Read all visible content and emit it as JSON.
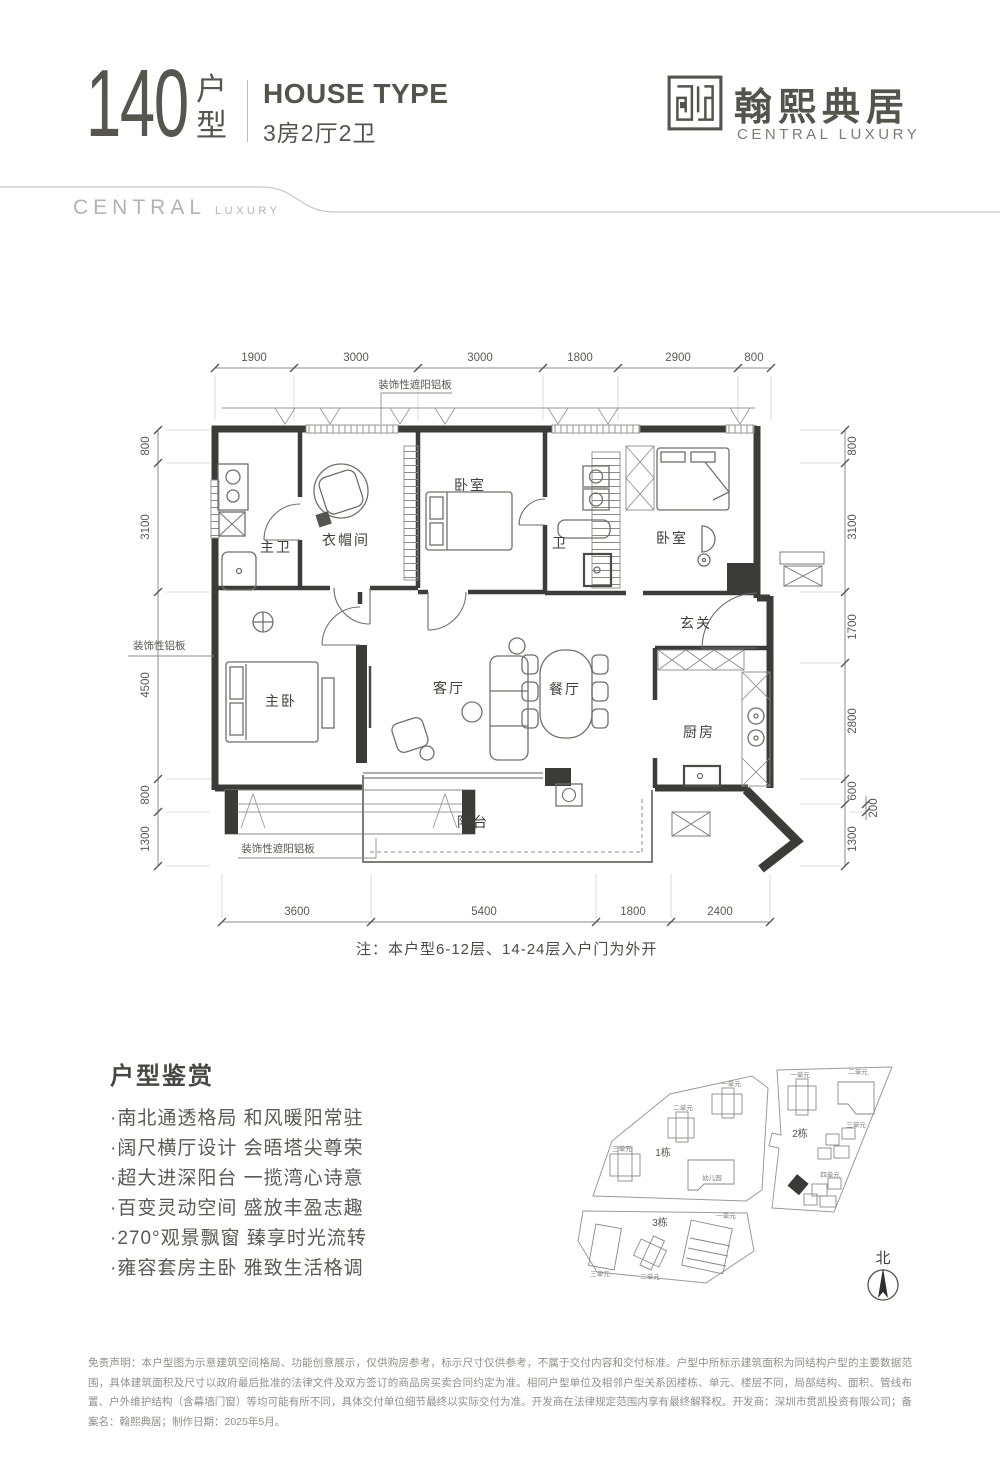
{
  "header": {
    "type_number": "140",
    "type_unit_top": "户",
    "type_unit_bottom": "型",
    "house_type_en": "HOUSE TYPE",
    "house_type_cn": "3房2厅2卫"
  },
  "brand": {
    "logo_cn": "翰熙典居",
    "logo_en": "CENTRAL LUXURY",
    "watermark_main": "CENTRAL",
    "watermark_sub": "LUXURY"
  },
  "floor_plan": {
    "dims_top": [
      "1900",
      "3000",
      "3000",
      "1800",
      "2900",
      "800"
    ],
    "dims_bottom": [
      "3600",
      "5400",
      "1800",
      "2400"
    ],
    "dims_left": [
      "800",
      "3100",
      "4500",
      "800",
      "1300"
    ],
    "dims_right": [
      "800",
      "3100",
      "1700",
      "2800",
      "600",
      "200",
      "1300"
    ],
    "rooms": {
      "master_bath": "主卫",
      "cloak_room": "衣帽间",
      "bedroom1": "卧室",
      "bath": "卫",
      "bedroom2": "卧室",
      "foyer": "玄关",
      "master_bedroom": "主卧",
      "living_room": "客厅",
      "dining_room": "餐厅",
      "kitchen": "厨房",
      "balcony": "阳台"
    },
    "annotation_top": "装饰性遮阳铝板",
    "annotation_left": "装饰性铝板",
    "annotation_bottom": "装饰性遮阳铝板",
    "note": "注：本户型6-12层、14-24层入户门为外开"
  },
  "features": {
    "title": "户型鉴赏",
    "items": [
      "·南北通透格局 和风暖阳常驻",
      "·阔尺横厅设计 会晤塔尖尊荣",
      "·超大进深阳台 一揽湾心诗意",
      "·百变灵动空间 盛放丰盈志趣",
      "·270°观景飘窗 臻享时光流转",
      "·雍容套房主卧 雅致生活格调"
    ]
  },
  "site_plan": {
    "parcel1": {
      "building": "1栋",
      "unit1": "一单元",
      "unit2": "二单元",
      "unit3": "三单元",
      "kindergarten": "幼儿园"
    },
    "parcel2": {
      "building": "2栋",
      "unit1": "一单元",
      "unit2": "二单元",
      "unit3": "三单元",
      "unit4": "四单元"
    },
    "parcel3": {
      "building": "3栋",
      "unit1": "一单元",
      "unit2": "二单元",
      "unit3": "三单元"
    },
    "north": "北"
  },
  "disclaimer": "免责声明：本户型图为示意建筑空间格局、功能创意展示，仅供购房参考，标示尺寸仅供参考，不属于交付内容和交付标准。户型中所标示建筑面积为同结构户型的主要数据范围，具体建筑面积及尺寸以政府最后批准的法律文件及双方签订的商品房买卖合同约定为准。相同户型单位及相邻户型关系因楼栋、单元、楼层不同，局部结构、面积、管线布置、户外维护结构（含幕墙门窗）等均可能有所不同，具体交付单位细节最终以实际交付为准。开发商在法律规定范围内享有最终解释权。开发商：深圳市贯凯投资有限公司；备案名：翰熙典居；制作日期：2025年5月。"
}
